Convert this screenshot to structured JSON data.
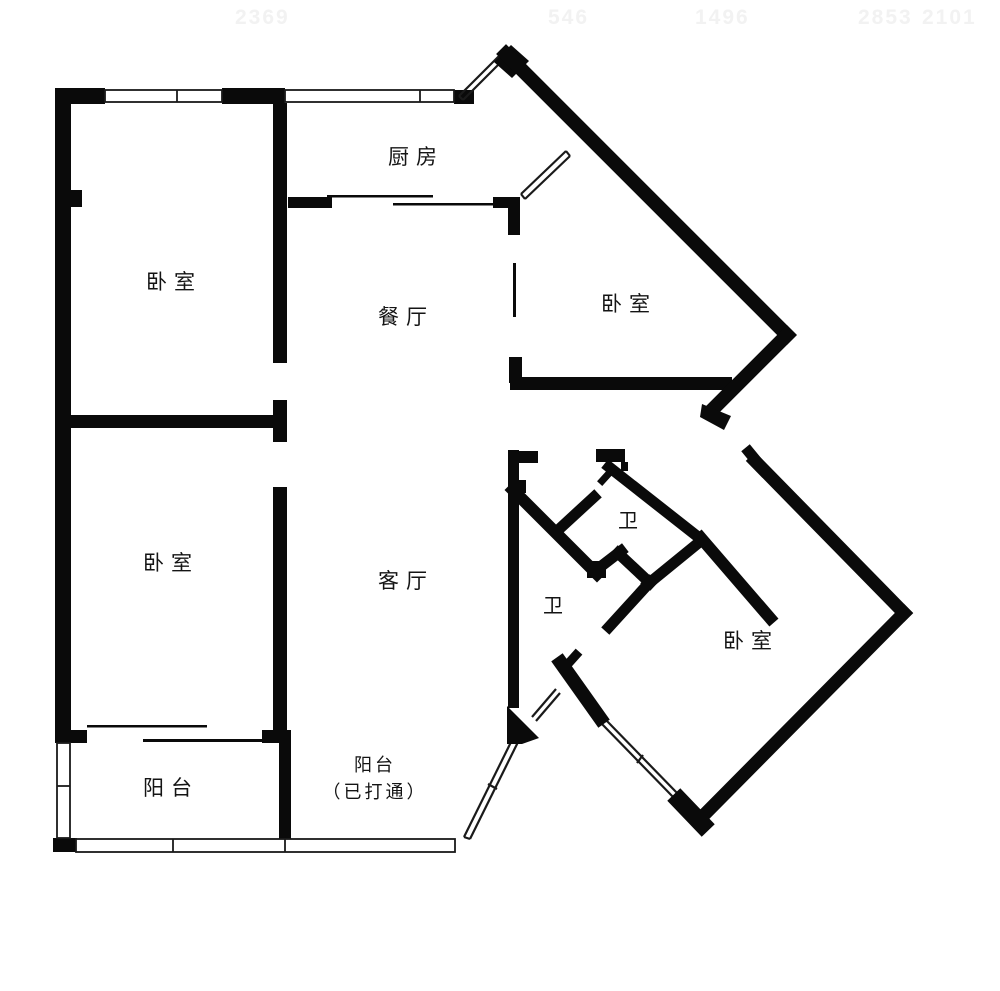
{
  "page": {
    "background": "#ffffff",
    "wall_color": "#0a0a0a",
    "window_line_color": "#1a1a1a"
  },
  "watermarks": [
    "2369",
    "546",
    "1496",
    "2853",
    "2101"
  ],
  "rooms": {
    "kitchen": {
      "label": "厨房"
    },
    "bedroom_top_left": {
      "label": "卧室"
    },
    "dining": {
      "label": "餐厅"
    },
    "bedroom_top_right": {
      "label": "卧室"
    },
    "bedroom_mid_left": {
      "label": "卧室"
    },
    "living": {
      "label": "客厅"
    },
    "bath_upper": {
      "label": "卫"
    },
    "bath_lower": {
      "label": "卫"
    },
    "bedroom_right": {
      "label": "卧室"
    },
    "balcony_left": {
      "label": "阳台"
    },
    "balcony_center": {
      "label_line1": "阳台",
      "label_line2": "（已打通）"
    }
  }
}
